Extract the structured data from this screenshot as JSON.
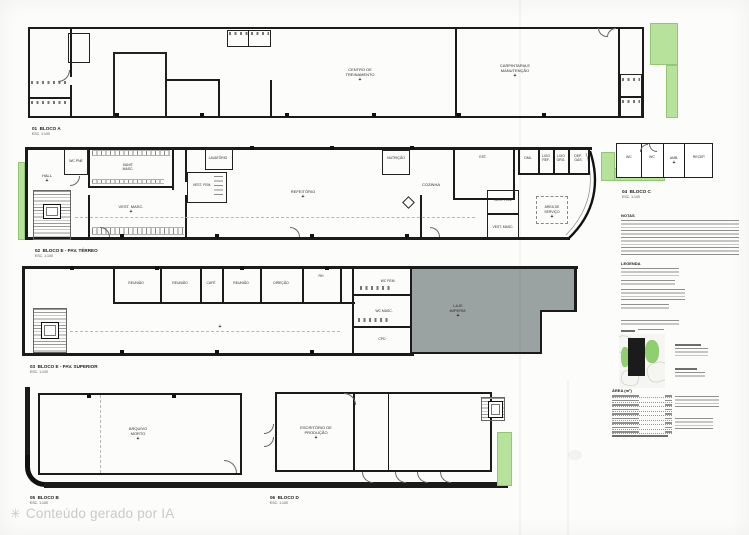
{
  "colors": {
    "paper": "#fcfcfa",
    "wall": "#1b1b1b",
    "landscape_green": "#b7e29c",
    "slab_gray": "#9ba3a2",
    "watermark_gray": "#c8cbc8"
  },
  "watermark": {
    "icon": "ai-sparkle",
    "text": "Conteúdo gerado por IA"
  },
  "panel": {
    "notes_title": "NOTAS",
    "legend_title": "LEGENDA",
    "area_title": "ÁREA (m²)"
  },
  "blocks": {
    "a": {
      "num": "01",
      "name": "BLOCO A",
      "scale": "ESC. 1:100",
      "rooms": {
        "treinamento": "CENTRO DE\nTREINAMENTO",
        "manutencao": "CARPINTARIA E\nMANUTENÇÃO"
      }
    },
    "e1": {
      "num": "02",
      "name": "BLOCO E - PAV. TÉRREO",
      "scale": "ESC. 1:100",
      "rooms": {
        "hall": "HALL",
        "wcpne": "WC PNE",
        "sanitmasc": "SANIT.\nMASC.",
        "vestmasc": "VEST. MASC.",
        "lavatorio": "LAVATÓRIO",
        "vestfem": "VEST. FEM.",
        "refeitorio": "REFEITÓRIO",
        "nutricao": "NUTRIÇÃO",
        "cozinha": "COZINHA",
        "est": "EST.",
        "dml": "DML",
        "lixoref": "LIXO\nREF.",
        "lixoorg": "LIXO\nORG.",
        "depgas": "DEP.\nGÁS",
        "vestfem2": "VEST. FEM.",
        "vestmasc2": "VEST. MASC.",
        "areaservico": "ÁREA DE\nSERVIÇO"
      }
    },
    "e2": {
      "num": "03",
      "name": "BLOCO E - PAV. SUPERIOR",
      "scale": "ESC. 1:100",
      "rooms": {
        "r1": "REUNIÃO",
        "r2": "REUNIÃO",
        "cafe": "CAFÉ",
        "r3": "REUNIÃO",
        "direcao": "DIREÇÃO",
        "rh": "RH",
        "wcfem": "WC FEM.",
        "wcmasc": "WC MASC.",
        "cpd": "CPD",
        "laje": "LAJE\nIMPERM."
      }
    },
    "c": {
      "num": "04",
      "name": "BLOCO C",
      "scale": "ESC. 1:100",
      "rooms": {
        "wc1": "WC",
        "wc2": "WC",
        "amb": "AMB.",
        "recep": "RECEP."
      }
    },
    "b": {
      "num": "05",
      "name": "BLOCO B",
      "scale": "ESC. 1:100",
      "rooms": {
        "arquivo": "ARQUIVO\nMORTO"
      }
    },
    "d": {
      "num": "06",
      "name": "BLOCO D",
      "scale": "ESC. 1:100",
      "rooms": {
        "producao": "ESCRITÓRIO DE\nPRODUÇÃO"
      }
    }
  }
}
